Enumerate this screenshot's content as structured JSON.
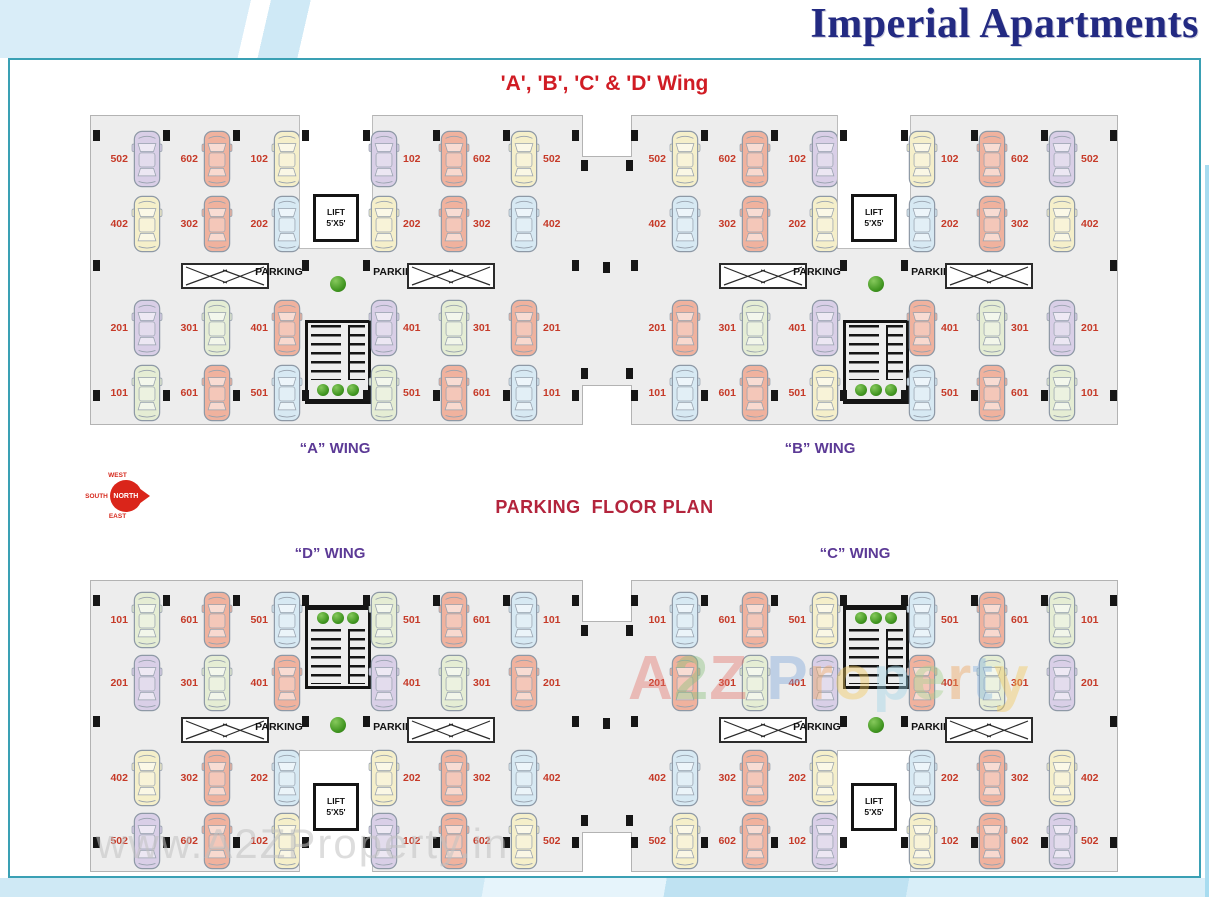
{
  "header": {
    "title": "Imperial Apartments"
  },
  "panel": {
    "heading": "'A', 'B', 'C' & 'D' Wing",
    "plan_title": "PARKING  FLOOR PLAN"
  },
  "compass": {
    "inner": "NORTH",
    "top": "WEST",
    "left": "SOUTH",
    "bottom": "EAST"
  },
  "labels": {
    "parking": "PARKING",
    "lift": "LIFT",
    "lift_size": "5'X5'"
  },
  "watermark": {
    "url_text": "www.A2ZProperty.in",
    "brand_letters": [
      {
        "ch": "A",
        "color": "#e4756b"
      },
      {
        "ch": "2",
        "color": "#8bc17c"
      },
      {
        "ch": "Z",
        "color": "#e4756b"
      },
      {
        "ch": " ",
        "color": "#ffffff"
      },
      {
        "ch": "P",
        "color": "#7fa8dc"
      },
      {
        "ch": "r",
        "color": "#eda45e"
      },
      {
        "ch": "o",
        "color": "#f2c95c"
      },
      {
        "ch": "p",
        "color": "#9fd4e8"
      },
      {
        "ch": "e",
        "color": "#a8d18f"
      },
      {
        "ch": "r",
        "color": "#eda45e"
      },
      {
        "ch": "t",
        "color": "#86b4e0"
      },
      {
        "ch": "y",
        "color": "#f2c95c"
      }
    ]
  },
  "colors": {
    "title_navy": "#232a82",
    "heading_red": "#d01c24",
    "plan_title_red": "#b3243c",
    "wing_label_purple": "#5c3a96",
    "spot_label_red": "#c63a28",
    "panel_border_teal": "#3aa0b4",
    "floor_gray": "#ededed",
    "car_purple": "#d9cfe7",
    "car_salmon": "#f0b29e",
    "car_yellow": "#f5efca",
    "car_blue": "#d7e9f3",
    "car_green": "#e5edd4"
  },
  "strips": [
    {
      "name": "top",
      "core_layout": "lift-top",
      "wings": [
        {
          "label": "“A” WING"
        },
        {
          "label": "“B” WING"
        }
      ],
      "sections": [
        {
          "label_side": "left",
          "ramp_side": "right",
          "rows": [
            [
              {
                "no": "502",
                "color": "purple"
              },
              {
                "no": "602",
                "color": "salmon"
              },
              {
                "no": "102",
                "color": "yellow"
              }
            ],
            [
              {
                "no": "402",
                "color": "yellow"
              },
              {
                "no": "302",
                "color": "salmon"
              },
              {
                "no": "202",
                "color": "blue"
              }
            ],
            [
              {
                "no": "201",
                "color": "purple"
              },
              {
                "no": "301",
                "color": "green"
              },
              {
                "no": "401",
                "color": "salmon"
              }
            ],
            [
              {
                "no": "101",
                "color": "green"
              },
              {
                "no": "601",
                "color": "salmon"
              },
              {
                "no": "501",
                "color": "blue"
              }
            ]
          ]
        },
        {
          "label_side": "right",
          "ramp_side": "left",
          "rows": [
            [
              {
                "no": "102",
                "color": "purple"
              },
              {
                "no": "602",
                "color": "salmon"
              },
              {
                "no": "502",
                "color": "yellow"
              }
            ],
            [
              {
                "no": "202",
                "color": "yellow"
              },
              {
                "no": "302",
                "color": "salmon"
              },
              {
                "no": "402",
                "color": "blue"
              }
            ],
            [
              {
                "no": "401",
                "color": "purple"
              },
              {
                "no": "301",
                "color": "green"
              },
              {
                "no": "201",
                "color": "salmon"
              }
            ],
            [
              {
                "no": "501",
                "color": "green"
              },
              {
                "no": "601",
                "color": "salmon"
              },
              {
                "no": "101",
                "color": "blue"
              }
            ]
          ]
        },
        {
          "label_side": "left",
          "ramp_side": "right",
          "rows": [
            [
              {
                "no": "502",
                "color": "yellow"
              },
              {
                "no": "602",
                "color": "salmon"
              },
              {
                "no": "102",
                "color": "purple"
              }
            ],
            [
              {
                "no": "402",
                "color": "blue"
              },
              {
                "no": "302",
                "color": "salmon"
              },
              {
                "no": "202",
                "color": "yellow"
              }
            ],
            [
              {
                "no": "201",
                "color": "salmon"
              },
              {
                "no": "301",
                "color": "green"
              },
              {
                "no": "401",
                "color": "purple"
              }
            ],
            [
              {
                "no": "101",
                "color": "blue"
              },
              {
                "no": "601",
                "color": "salmon"
              },
              {
                "no": "501",
                "color": "yellow"
              }
            ]
          ]
        },
        {
          "label_side": "right",
          "ramp_side": "left",
          "rows": [
            [
              {
                "no": "102",
                "color": "yellow"
              },
              {
                "no": "602",
                "color": "salmon"
              },
              {
                "no": "502",
                "color": "purple"
              }
            ],
            [
              {
                "no": "202",
                "color": "blue"
              },
              {
                "no": "302",
                "color": "salmon"
              },
              {
                "no": "402",
                "color": "yellow"
              }
            ],
            [
              {
                "no": "401",
                "color": "salmon"
              },
              {
                "no": "301",
                "color": "green"
              },
              {
                "no": "201",
                "color": "purple"
              }
            ],
            [
              {
                "no": "501",
                "color": "blue"
              },
              {
                "no": "601",
                "color": "salmon"
              },
              {
                "no": "101",
                "color": "green"
              }
            ]
          ]
        }
      ]
    },
    {
      "name": "bottom",
      "core_layout": "stairs-top",
      "wings": [
        {
          "label": "“D” WING"
        },
        {
          "label": "“C” WING"
        }
      ],
      "sections": [
        {
          "label_side": "left",
          "ramp_side": "right",
          "rows": [
            [
              {
                "no": "101",
                "color": "green"
              },
              {
                "no": "601",
                "color": "salmon"
              },
              {
                "no": "501",
                "color": "blue"
              }
            ],
            [
              {
                "no": "201",
                "color": "purple"
              },
              {
                "no": "301",
                "color": "green"
              },
              {
                "no": "401",
                "color": "salmon"
              }
            ],
            [
              {
                "no": "402",
                "color": "yellow"
              },
              {
                "no": "302",
                "color": "salmon"
              },
              {
                "no": "202",
                "color": "blue"
              }
            ],
            [
              {
                "no": "502",
                "color": "purple"
              },
              {
                "no": "602",
                "color": "salmon"
              },
              {
                "no": "102",
                "color": "yellow"
              }
            ]
          ]
        },
        {
          "label_side": "right",
          "ramp_side": "left",
          "rows": [
            [
              {
                "no": "501",
                "color": "green"
              },
              {
                "no": "601",
                "color": "salmon"
              },
              {
                "no": "101",
                "color": "blue"
              }
            ],
            [
              {
                "no": "401",
                "color": "purple"
              },
              {
                "no": "301",
                "color": "green"
              },
              {
                "no": "201",
                "color": "salmon"
              }
            ],
            [
              {
                "no": "202",
                "color": "yellow"
              },
              {
                "no": "302",
                "color": "salmon"
              },
              {
                "no": "402",
                "color": "blue"
              }
            ],
            [
              {
                "no": "102",
                "color": "purple"
              },
              {
                "no": "602",
                "color": "salmon"
              },
              {
                "no": "502",
                "color": "yellow"
              }
            ]
          ]
        },
        {
          "label_side": "left",
          "ramp_side": "right",
          "rows": [
            [
              {
                "no": "101",
                "color": "blue"
              },
              {
                "no": "601",
                "color": "salmon"
              },
              {
                "no": "501",
                "color": "yellow"
              }
            ],
            [
              {
                "no": "201",
                "color": "salmon"
              },
              {
                "no": "301",
                "color": "green"
              },
              {
                "no": "401",
                "color": "purple"
              }
            ],
            [
              {
                "no": "402",
                "color": "blue"
              },
              {
                "no": "302",
                "color": "salmon"
              },
              {
                "no": "202",
                "color": "yellow"
              }
            ],
            [
              {
                "no": "502",
                "color": "yellow"
              },
              {
                "no": "602",
                "color": "salmon"
              },
              {
                "no": "102",
                "color": "purple"
              }
            ]
          ]
        },
        {
          "label_side": "right",
          "ramp_side": "left",
          "rows": [
            [
              {
                "no": "501",
                "color": "blue"
              },
              {
                "no": "601",
                "color": "salmon"
              },
              {
                "no": "101",
                "color": "green"
              }
            ],
            [
              {
                "no": "401",
                "color": "salmon"
              },
              {
                "no": "301",
                "color": "green"
              },
              {
                "no": "201",
                "color": "purple"
              }
            ],
            [
              {
                "no": "202",
                "color": "blue"
              },
              {
                "no": "302",
                "color": "salmon"
              },
              {
                "no": "402",
                "color": "yellow"
              }
            ],
            [
              {
                "no": "102",
                "color": "yellow"
              },
              {
                "no": "602",
                "color": "salmon"
              },
              {
                "no": "502",
                "color": "purple"
              }
            ]
          ]
        }
      ]
    }
  ]
}
